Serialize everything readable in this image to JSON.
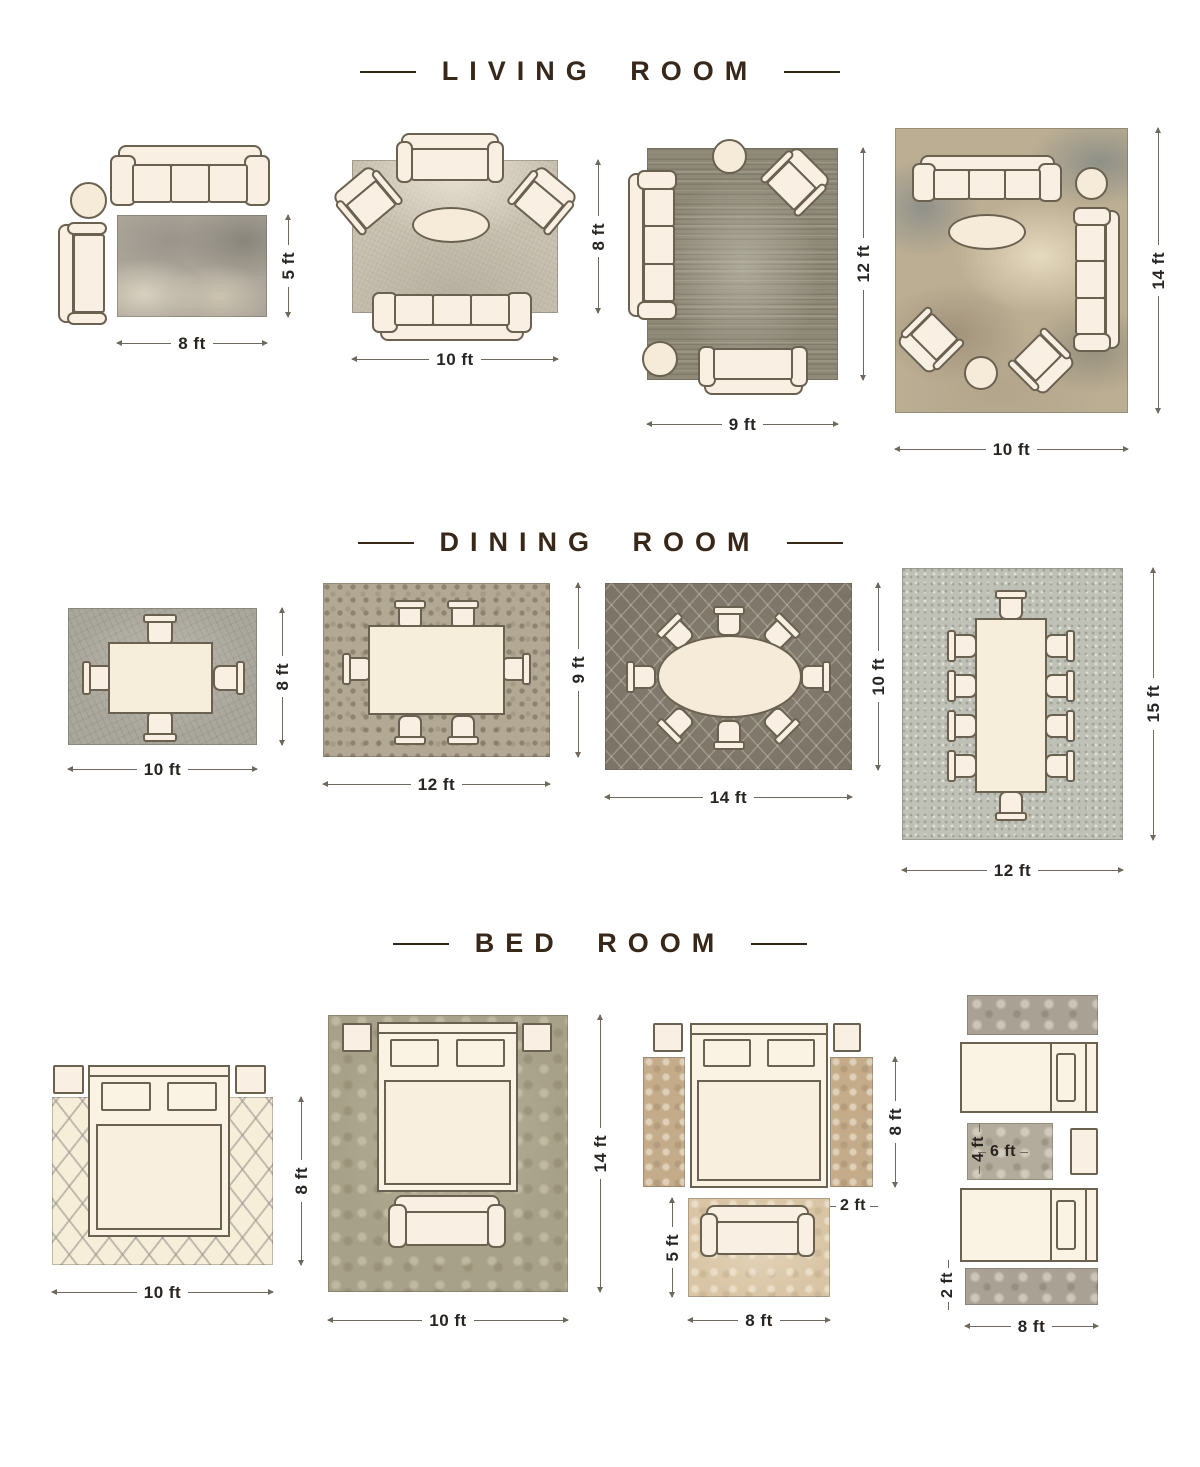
{
  "colors": {
    "background": "#ffffff",
    "title_text": "#37281a",
    "dimension_text": "#282420",
    "dimension_line": "#6f695d",
    "furniture_fill": "#f9efe2",
    "furniture_outline": "#6a6150"
  },
  "sections": [
    {
      "title": "LIVING ROOM",
      "diagrams": [
        {
          "bottom": "8 ft",
          "side": "5 ft"
        },
        {
          "bottom": "10 ft",
          "side": "8 ft"
        },
        {
          "bottom": "9 ft",
          "side": "12 ft"
        },
        {
          "bottom": "10 ft",
          "side": "14 ft"
        }
      ]
    },
    {
      "title": "DINING ROOM",
      "diagrams": [
        {
          "bottom": "10 ft",
          "side": "8 ft"
        },
        {
          "bottom": "12 ft",
          "side": "9 ft"
        },
        {
          "bottom": "14 ft",
          "side": "10 ft"
        },
        {
          "bottom": "12 ft",
          "side": "15 ft"
        }
      ]
    },
    {
      "title": "BED ROOM",
      "diagrams": [
        {
          "bottom": "10 ft",
          "side": "8 ft"
        },
        {
          "bottom": "10 ft",
          "side": "14 ft"
        },
        {
          "bottom": "8 ft",
          "runner_side": "8 ft",
          "runner_width": "2 ft",
          "foot_rug_side": "5 ft"
        },
        {
          "bottom": "8 ft",
          "accent_width": "6 ft",
          "accent_height": "4 ft",
          "runner_height": "2 ft"
        }
      ]
    }
  ]
}
